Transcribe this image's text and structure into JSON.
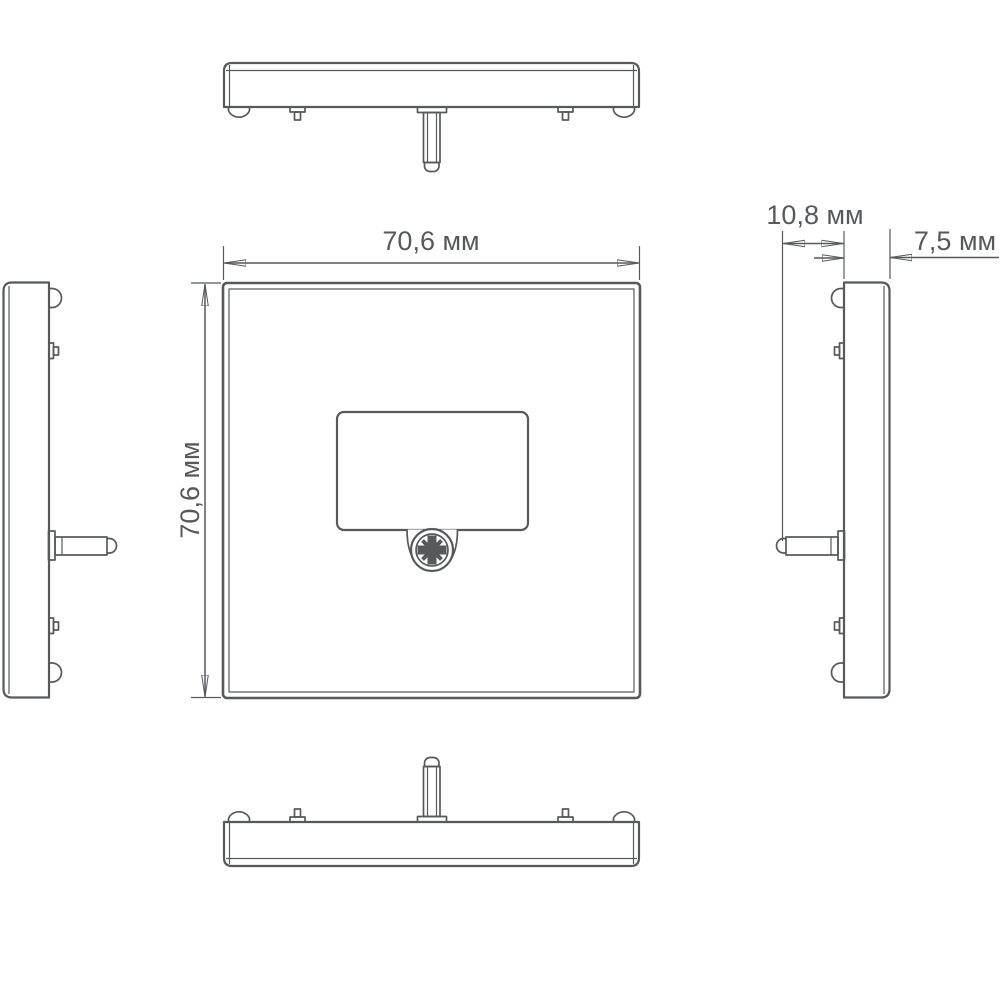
{
  "drawing": {
    "type": "technical-dimension-drawing",
    "background_color": "#ffffff",
    "line_color": "#58595b",
    "unit": "мм",
    "views": [
      "top",
      "front",
      "left-side",
      "right-side",
      "bottom"
    ],
    "dimensions": {
      "width": {
        "label": "70,6 мм",
        "value": 70.6,
        "unit": "мм"
      },
      "height": {
        "label": "70,6 мм",
        "value": 70.6,
        "unit": "мм"
      },
      "depth_overall": {
        "label": "10,8 мм",
        "value": 10.8,
        "unit": "мм"
      },
      "depth_body": {
        "label": "7,5 мм",
        "value": 7.5,
        "unit": "мм"
      }
    }
  }
}
